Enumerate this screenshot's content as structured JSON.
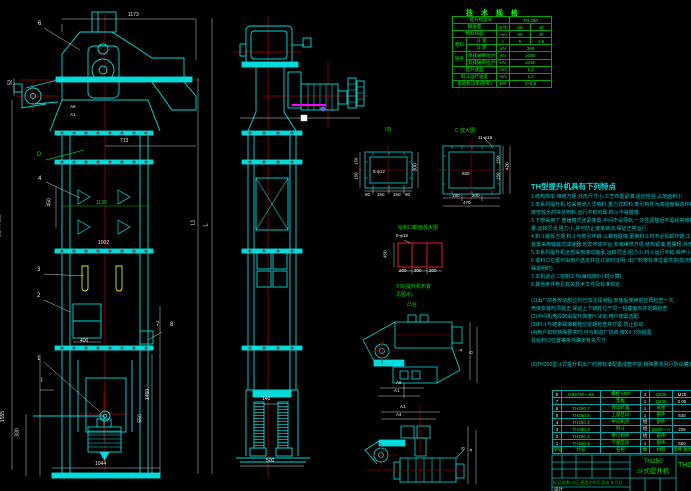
{
  "colors": {
    "background": "#000000",
    "line_cyan": "#00dcdc",
    "line_green": "#00c000",
    "centerline_red": "#b40000",
    "grid_red": "#ff1e1e",
    "bucket_yellow": "#e8e800",
    "highlight_magenta": "#ff00ff",
    "dim_white": "#e8e8e8"
  },
  "labels": {
    "dim_1173": "1173",
    "balloon_6": "6",
    "dim_52": "52",
    "dim_a8": "A8",
    "dim_a1": "A1",
    "dim_713": "713",
    "label_d": "D",
    "balloon_4": "4",
    "dim_450": "450",
    "dim_1130": "1130",
    "dim_1002": "1002",
    "balloon_3": "3",
    "balloon_2": "2",
    "text_h": "H(提升高度)",
    "dim_l1": "L1",
    "dim_l": "L",
    "dim_400": "400",
    "balloon_7": "7",
    "balloon_8": "8",
    "balloon_1": "1",
    "label_i": "I",
    "dim_1555": "1555",
    "dim_330": "330",
    "dim_1450": "1450",
    "dim_550": "550",
    "dim_1044": "1044",
    "dim_140": "140",
    "dim_500": "500",
    "view_i": "I向",
    "callout_8_12": "8-φ12",
    "dim_300": "300",
    "dim_150a": "150",
    "dim_150b": "150",
    "dim_i_90a": "90",
    "dim_i_150a": "150",
    "dim_i_150b": "150",
    "dim_i_90b": "90",
    "view_c": "C 放大图",
    "callout_11_18": "11-φ18",
    "dim_650": "650",
    "dim_c_190": "190",
    "dim_c_200": "200",
    "dim_c_470": "470",
    "dim_c_150a": "150",
    "dim_c_150b": "150",
    "dim_c_420": "420",
    "feed_title": "给料口断面放大图",
    "callout_8_18": "8-φ18",
    "dim_450b": "450",
    "dim_f_200a": "200",
    "dim_f_300": "300",
    "dim_f_200b": "200",
    "note_y1": "Y向(提升机布置",
    "note_y2": "见图示)",
    "label_boss": "凸台",
    "sv1_dim_a": "a",
    "sv1_dim_b": "B",
    "sv1_a8": "A8",
    "sv1_a1": "A1",
    "sv2_a1": "A1",
    "sv2_a4": "A4",
    "sv2_dim_b": "B",
    "sv2_dim_a": "a"
  },
  "spec": {
    "title": "技 术 规 格",
    "r1l": "提升机型号",
    "r1v": "TH 250",
    "r2l": "输送量",
    "r2u": "m³/h",
    "r2v1": "25",
    "r2v2": "40",
    "r3l": "物料块度",
    "r3u": "mm",
    "r3v1": "50",
    "r3v2": "40",
    "g1": "物料",
    "r4l": "斗 宽",
    "r4u": "t",
    "r4v1": "5",
    "r4v2": "1.5",
    "r5l": "斗 距",
    "r5u": "kN",
    "r5v": "380",
    "g2": "链条",
    "r6l": "单排破断拉力",
    "r6u": "kN",
    "r6v": "≥380",
    "r7l": "双排破断拉力",
    "r7u": "kN",
    "r7v": "≥250",
    "r8l": "提升速度",
    "r8u": "m/s",
    "r8v": "1.4",
    "r9l": "料斗运行速度",
    "r9u": "m/s",
    "r9v": "1.2",
    "r10l": "电动机功率(参考)",
    "r10u": "kW",
    "r10v": "4~5.5"
  },
  "notes": {
    "title": "TH型提升机具有下列特点",
    "lines": [
      "1.结构简单,维修方便,外形尺寸小,工艺布置紧凑,适应性强,占地面积小.",
      "2.本系列提升机 均采用流入式喂料,重力式卸料,牵引构件为高强度锻造环链,耐磨损,适于输送磨",
      "  琢性较大的块状物料,运行平稳可靠,料斗不易脱落.",
      "3.下部采用了 重锤箱式张紧装置,中间不设导轨,一次性调整后不需经常维护,大大减少了维修工作",
      "  量,运转灵活,阻力小,并可防止链条跳动,保证正常运行.",
      "4.料斗装拆方便,料斗与牵引环链 以螺栓联接,更换料斗时不必拆卸环链,工作可靠,使用寿命长,驱动",
      "  装置采用轴装式减速器,省去传动平台,安装维修方便,结构紧凑,重量轻,外形尺寸小.",
      "5.本系列提升机全部采用滚动轴承,运转灵活,阻力小,料斗运行平稳,噪声小,密封性能好.",
      "6.进料口位置可由用户选定并在订货时注明,          出厂时按标准位置供货(如无特",
      "  殊说明时).",
      "7.本机适合二班制工作(每班按8小时计算).",
      "8.其他条件参见有关技术文件及标准规定.",
      "",
      "(1)出厂前各传动部位均已加注润滑脂,安装后使用前应再检查一次,",
      "  壳体安装时须找正,保证上下链轮位于同一铅垂面内并定期检查.",
      "(2)中间机壳段数由提升高度H 决定,用户按需选配.",
      "(3)料斗与链条联接螺栓应定期检查并拧紧,防止松动.",
      "(4)用户如有特殊要求时,可与制造厂协商,按XX,Y向视图,",
      "  及给料口位置等条件确定有关尺寸.",
      "",
      "",
      "(9)TH250型斗式提升机出厂时按标准配置成套供货,特殊要求另行协议确定."
    ]
  },
  "bom": {
    "rows": [
      {
        "n": "8",
        "code": "GB5782—86",
        "name": "螺栓 M20",
        "qty": "4",
        "mat": "Q235",
        "wt": "M20"
      },
      {
        "n": "7",
        "code": "",
        "name": "垫板",
        "qty": "1",
        "mat": "Q235",
        "wt": "0.05"
      },
      {
        "n": "6",
        "code": "TH250.7",
        "name": "传动装置",
        "qty": "1",
        "mat": "总图",
        "wt": ""
      },
      {
        "n": "5",
        "code": "TH250.6",
        "name": "上部区段",
        "qty": "1",
        "mat": "部件",
        "wt": "635"
      },
      {
        "n": "4",
        "code": "TH250.4",
        "name": "中间机壳",
        "qty": "组",
        "mat": "部件",
        "wt": ""
      },
      {
        "n": "3",
        "code": "TH250.3",
        "name": "料斗",
        "qty": "组",
        "mat": "Q235—A",
        "wt": "205"
      },
      {
        "n": "2",
        "code": "TH250.2",
        "name": "牵引构件",
        "qty": "组",
        "mat": "部件",
        "wt": ""
      },
      {
        "n": "1",
        "code": "TH250.1",
        "name": "下部区段",
        "qty": "1",
        "mat": "部件",
        "wt": "650"
      }
    ],
    "footer": {
      "n": "序号",
      "code": "代号",
      "name": "名称",
      "qty": "数",
      "mat": "材料",
      "wt": "单件 总计"
    }
  },
  "title_block": {
    "model": "TH250",
    "product": "斗式提升机",
    "code": "TH2",
    "rev_row": "标记 处数 分区 更改文件号 签名 年月日",
    "designer": "设计"
  }
}
